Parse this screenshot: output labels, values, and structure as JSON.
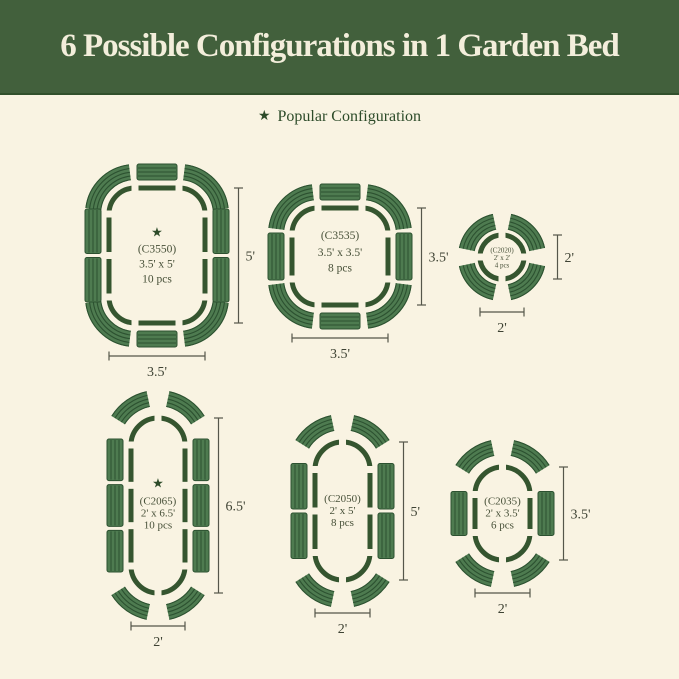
{
  "page": {
    "width": 679,
    "height": 679
  },
  "colors": {
    "background": "#f9f3e2",
    "header_bg": "#42603c",
    "header_border": "#31502c",
    "header_text": "#f3eedb",
    "legend_text": "#2d4b29",
    "outline": "#35552f",
    "panel_fill": "#4e7b50",
    "panel_stripe": "#2c5130",
    "dim_line": "#55564a",
    "dim_text": "#3e4233",
    "center_text": "#475038",
    "star": "#2d4b29"
  },
  "header": {
    "title": "6 Possible Configurations in 1 Garden Bed"
  },
  "legend": {
    "star_glyph": "★",
    "label": "Popular Configuration"
  },
  "configs": [
    {
      "id": "C3550",
      "label": "(C3550)",
      "size": "3.5' x 5'",
      "pieces": "10 pcs",
      "popular": true,
      "shape": "rect",
      "x": 109,
      "y": 188,
      "w": 96,
      "h": 135,
      "r": 26,
      "side_panels": 2,
      "dim_right": "5'",
      "dim_bottom": "3.5'"
    },
    {
      "id": "C3535",
      "label": "(C3535)",
      "size": "3.5' x 3.5'",
      "pieces": "8 pcs",
      "popular": false,
      "shape": "rect",
      "x": 292,
      "y": 208,
      "w": 96,
      "h": 97,
      "r": 26,
      "side_panels": 1,
      "dim_right": "3.5'",
      "dim_bottom": "3.5'"
    },
    {
      "id": "C2020",
      "label": "(C2020)",
      "size": "2' x 2'",
      "pieces": "4 pcs",
      "popular": false,
      "shape": "circle",
      "x": 480,
      "y": 235,
      "w": 44,
      "h": 44,
      "r": 22,
      "side_panels": 0,
      "dim_right": "2'",
      "dim_bottom": "2'"
    },
    {
      "id": "C2065",
      "label": "(C2065)",
      "size": "2' x 6.5'",
      "pieces": "10 pcs",
      "popular": true,
      "shape": "capsule",
      "x": 131,
      "y": 418,
      "w": 54,
      "h": 175,
      "r": 27,
      "side_panels": 3,
      "dim_right": "6.5'",
      "dim_bottom": "2'"
    },
    {
      "id": "C2050",
      "label": "(C2050)",
      "size": "2' x 5'",
      "pieces": "8 pcs",
      "popular": false,
      "shape": "capsule",
      "x": 315,
      "y": 442,
      "w": 55,
      "h": 138,
      "r": 27.5,
      "side_panels": 2,
      "dim_right": "5'",
      "dim_bottom": "2'"
    },
    {
      "id": "C2035",
      "label": "(C2035)",
      "size": "2' x 3.5'",
      "pieces": "6 pcs",
      "popular": false,
      "shape": "capsule",
      "x": 475,
      "y": 467,
      "w": 55,
      "h": 93,
      "r": 27.5,
      "side_panels": 1,
      "dim_right": "3.5'",
      "dim_bottom": "2'"
    }
  ]
}
